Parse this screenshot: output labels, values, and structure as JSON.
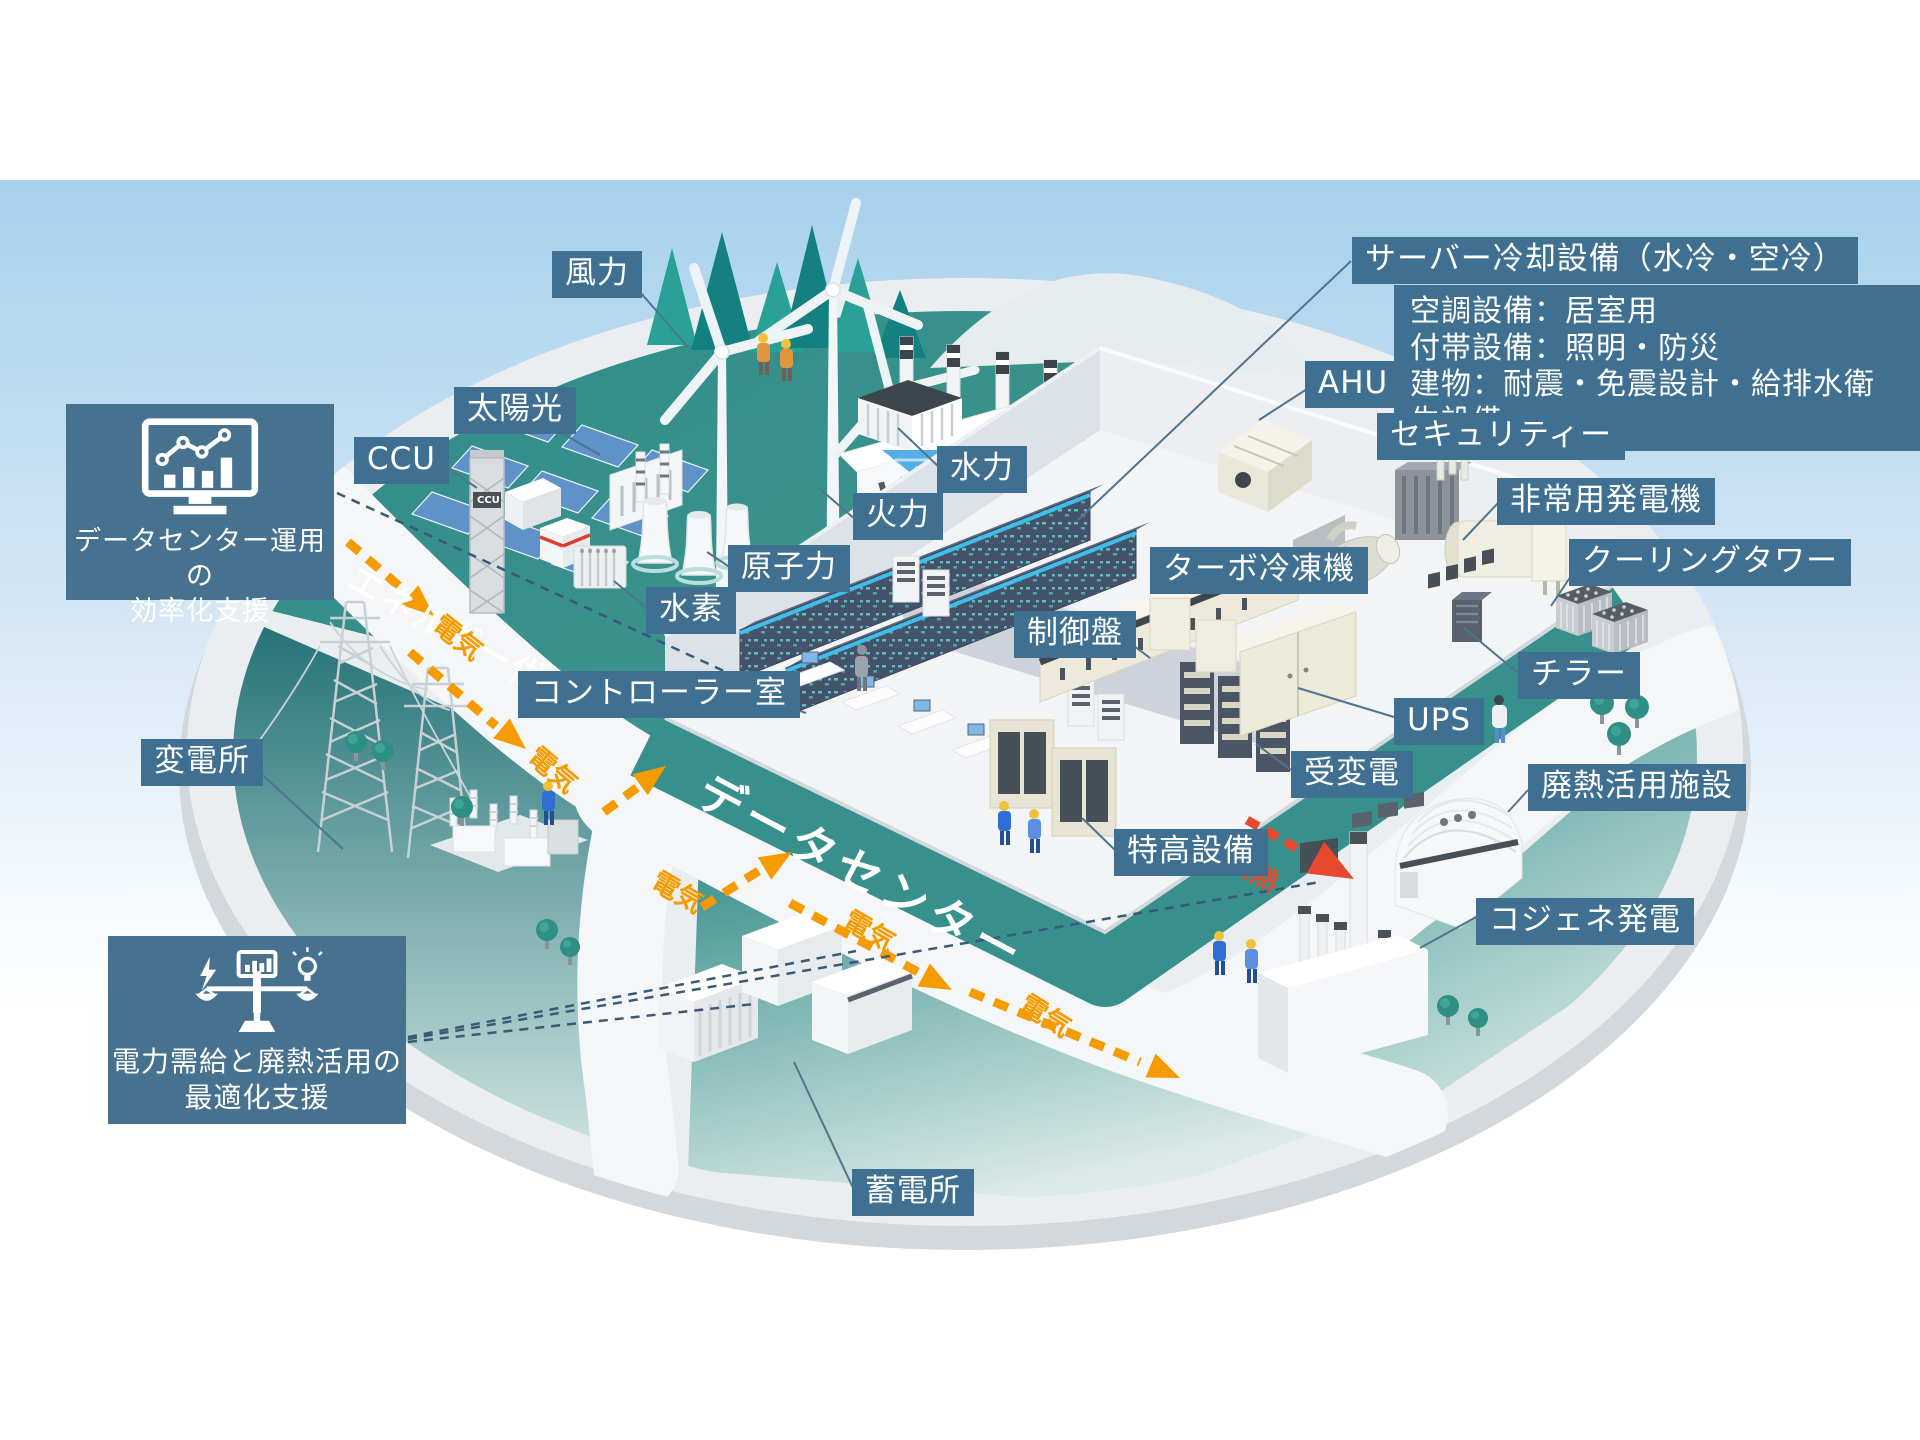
{
  "title": "データセンターとエネルギー供給の俯瞰図",
  "callouts": {
    "wind": "風力",
    "solar": "太陽光",
    "ccu": "CCU",
    "hydro": "水力",
    "thermal": "火力",
    "nuclear": "原子力",
    "hydrogen": "水素",
    "controller_room": "コントローラー室",
    "substation": "変電所",
    "storage": "蓄電所",
    "server_cooling": "サーバー冷却設備（水冷・空冷）",
    "ahu": "AHU",
    "security": "セキュリティー",
    "emergency_generator": "非常用発電機",
    "cooling_tower": "クーリングタワー",
    "turbo_chiller": "ターボ冷凍機",
    "chiller": "チラー",
    "ups": "UPS",
    "receiving_transforming": "受変電",
    "extra_high_voltage": "特高設備",
    "control_panel": "制御盤",
    "waste_heat_facility": "廃熱活用施設",
    "cogeneration": "コジェネ発電"
  },
  "info_box": {
    "line1": "空調設備：居室用",
    "line2": "付帯設備：照明・防災",
    "line3": "建物：耐震・免震設計・給排水衛生設備"
  },
  "support_boxes": {
    "dc_operation": {
      "line1": "データセンター運用の",
      "line2": "効率化支援"
    },
    "power_balance": {
      "line1": "電力需給と廃熱活用の",
      "line2": "最適化支援"
    }
  },
  "road_labels": {
    "energy_supply": "エネルギー供給",
    "datacenter": "データセンター",
    "electricity": "電気",
    "waste_heat": "廃熱"
  },
  "small_text": {
    "ccu_tower": "CCU"
  },
  "icons": {
    "dc_operation_icon": "monitor-chart-icon",
    "power_balance_icon": "balance-scale-icon"
  },
  "colors": {
    "label_bg": "#3f7092",
    "electricity_orange": "#f59b00",
    "waste_heat_red": "#e8492e",
    "teal_zone": "#2f8e8a",
    "sky_top": "#a9d2ec"
  }
}
